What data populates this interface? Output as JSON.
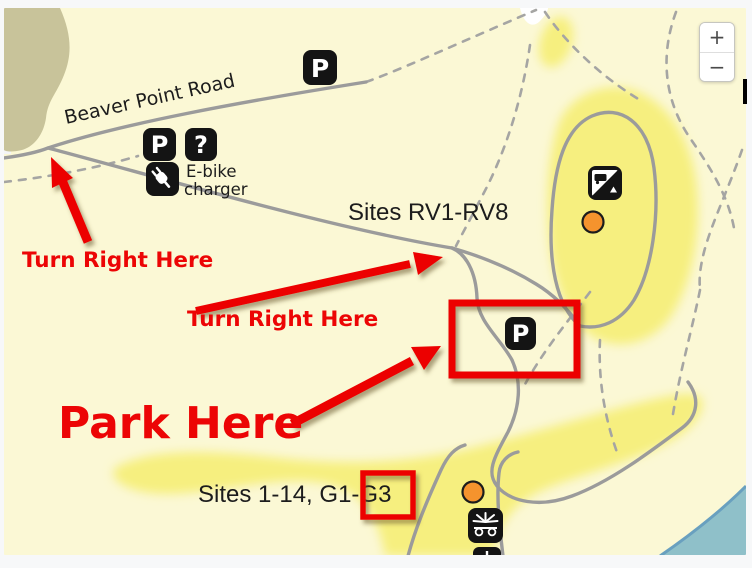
{
  "map": {
    "road_label": "Beaver Point Road",
    "labels": {
      "rv_sites": "Sites RV1-RV8",
      "tent_sites": "Sites 1-14, G1-G3",
      "ebike_line1": "E-bike",
      "ebike_line2": "charger"
    },
    "annotations": {
      "turn_right_1": "Turn Right Here",
      "turn_right_2": "Turn Right Here",
      "park_here": "Park Here"
    },
    "icons": {
      "parking_glyph": "P",
      "info_glyph": "?"
    },
    "colors": {
      "page_bg": "#f7f8f9",
      "map_bg": "#fbf8d5",
      "terrain_olive": "#c8c39a",
      "campsite_highlight": "#f6ef7f",
      "water": "#8fc0c9",
      "road": "#9b9b9b",
      "annotation_red": "#ec0505",
      "marker_orange": "#f5932d",
      "icon_black": "#141414"
    }
  },
  "controls": {
    "zoom_in": "+",
    "zoom_out": "−"
  }
}
